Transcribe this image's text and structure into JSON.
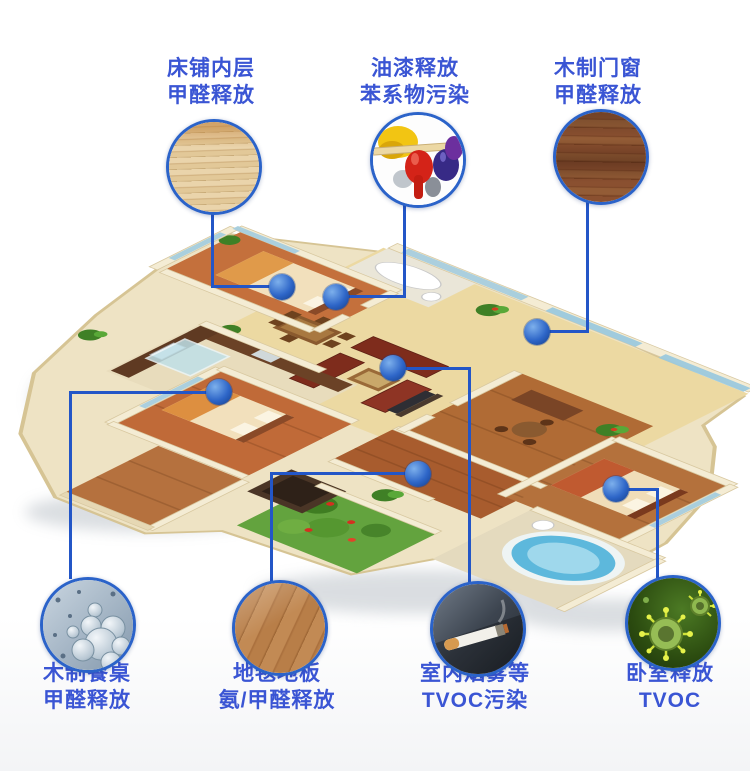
{
  "colors": {
    "label_text": "#3a55d4",
    "connector_line": "#2356c7",
    "circle_border": "#2b63c9",
    "dot_fill": "#2e66c8"
  },
  "callouts": [
    {
      "id": "bed-inner-layer",
      "line1": "床铺内层",
      "line2": "甲醛释放",
      "icon": "bed-slats-photo",
      "position": "top-left"
    },
    {
      "id": "paint-release",
      "line1": "油漆释放",
      "line2": "苯系物污染",
      "icon": "paint-cans-photo",
      "position": "top-center"
    },
    {
      "id": "wood-doors-windows",
      "line1": "木制门窗",
      "line2": "甲醛释放",
      "icon": "dark-wood-grain-photo",
      "position": "top-right"
    },
    {
      "id": "wood-dining-table",
      "line1": "木制餐桌",
      "line2": "甲醛释放",
      "icon": "molecule-cluster-photo",
      "position": "bottom-left"
    },
    {
      "id": "carpet-floor",
      "line1": "地毯地板",
      "line2": "氨/甲醛释放",
      "icon": "wood-floor-photo",
      "position": "bottom-center-left"
    },
    {
      "id": "indoor-smoke",
      "line1": "室内烟雾等",
      "line2": "TVOC污染",
      "icon": "cigarette-smoke-photo",
      "position": "bottom-center-right"
    },
    {
      "id": "bedroom-tvoc",
      "line1": "卧室释放",
      "line2": "TVOC",
      "icon": "virus-cells-photo",
      "position": "bottom-right"
    }
  ]
}
